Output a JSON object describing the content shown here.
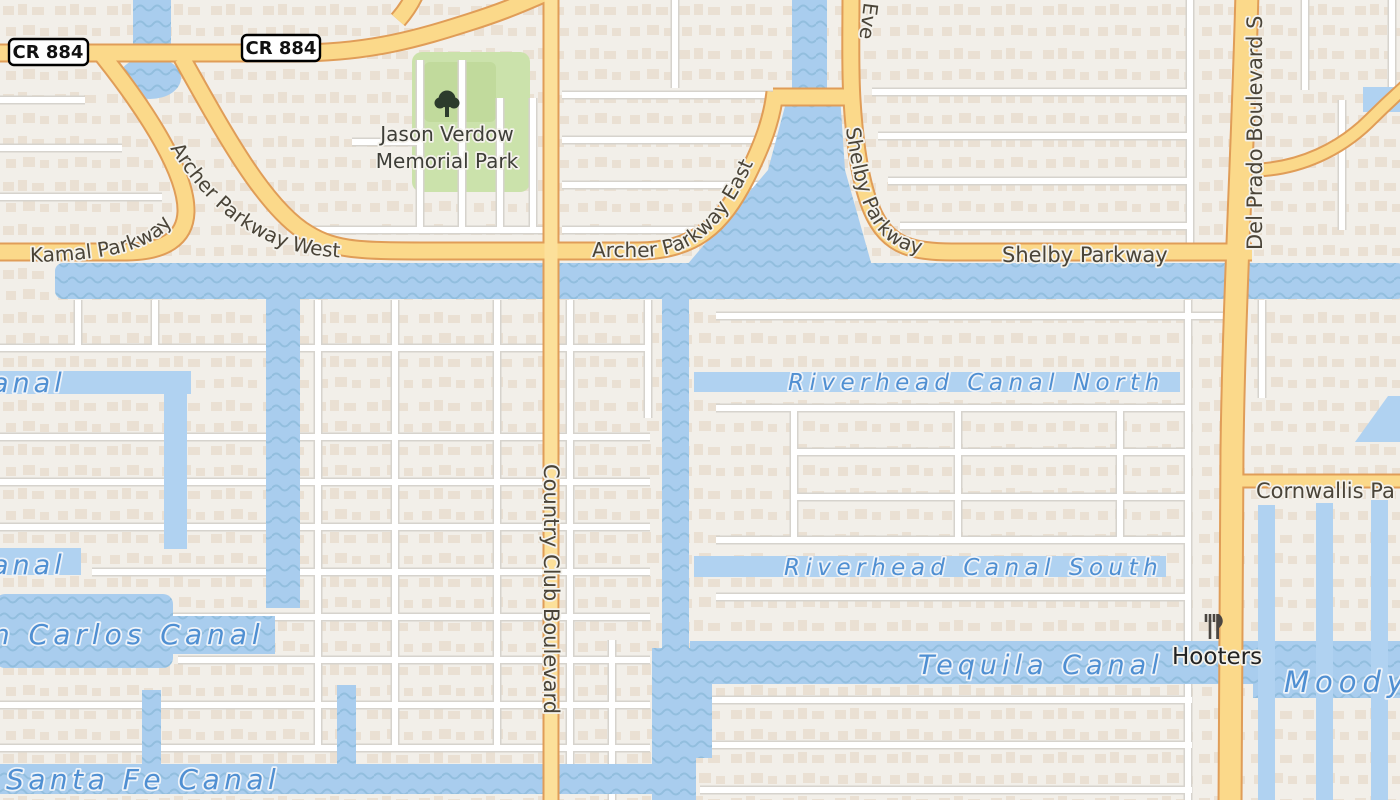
{
  "colors": {
    "land": "#f2efe9",
    "water": "#a9cdee",
    "water_wave": "#92bede",
    "water_ribbon": "#b0d2f1",
    "road_fill": "#fbd98a",
    "road_casing": "#e09d58",
    "street_fill": "#ffffff",
    "street_casing": "#d6d3cd",
    "park": "#cbe2ab",
    "building": "#e8dccd",
    "road_label": "#4a4438",
    "canal_label": "#4f8fd2",
    "poi_label": "#222222"
  },
  "shields": {
    "cr884_left": "CR 884",
    "cr884_right": "CR 884"
  },
  "park": {
    "name_line1": "Jason Verdow",
    "name_line2": "Memorial Park"
  },
  "roads": {
    "kamal": "Kamal Parkway",
    "archer_west": "Archer Parkway West",
    "archer_east": "Archer Parkway East",
    "shelby_curve": "Shelby Parkway",
    "shelby": "Shelby Parkway",
    "everest_partial": "Eve",
    "country_club": "Country Club Boulevard",
    "del_prado": "Del Prado Boulevard S",
    "cornwallis_partial": "Cornwallis Pa"
  },
  "canals": {
    "clipped_canal_1": "anal",
    "clipped_canal_2": "anal",
    "san_carlos_partial": "n Carlos Canal",
    "santa_fe": "Santa Fe Canal",
    "riverhead_north": "Riverhead Canal North",
    "riverhead_south": "Riverhead Canal South",
    "tequila": "Tequila Canal",
    "moody_partial": "Moody C"
  },
  "pois": {
    "hooters": "Hooters"
  }
}
